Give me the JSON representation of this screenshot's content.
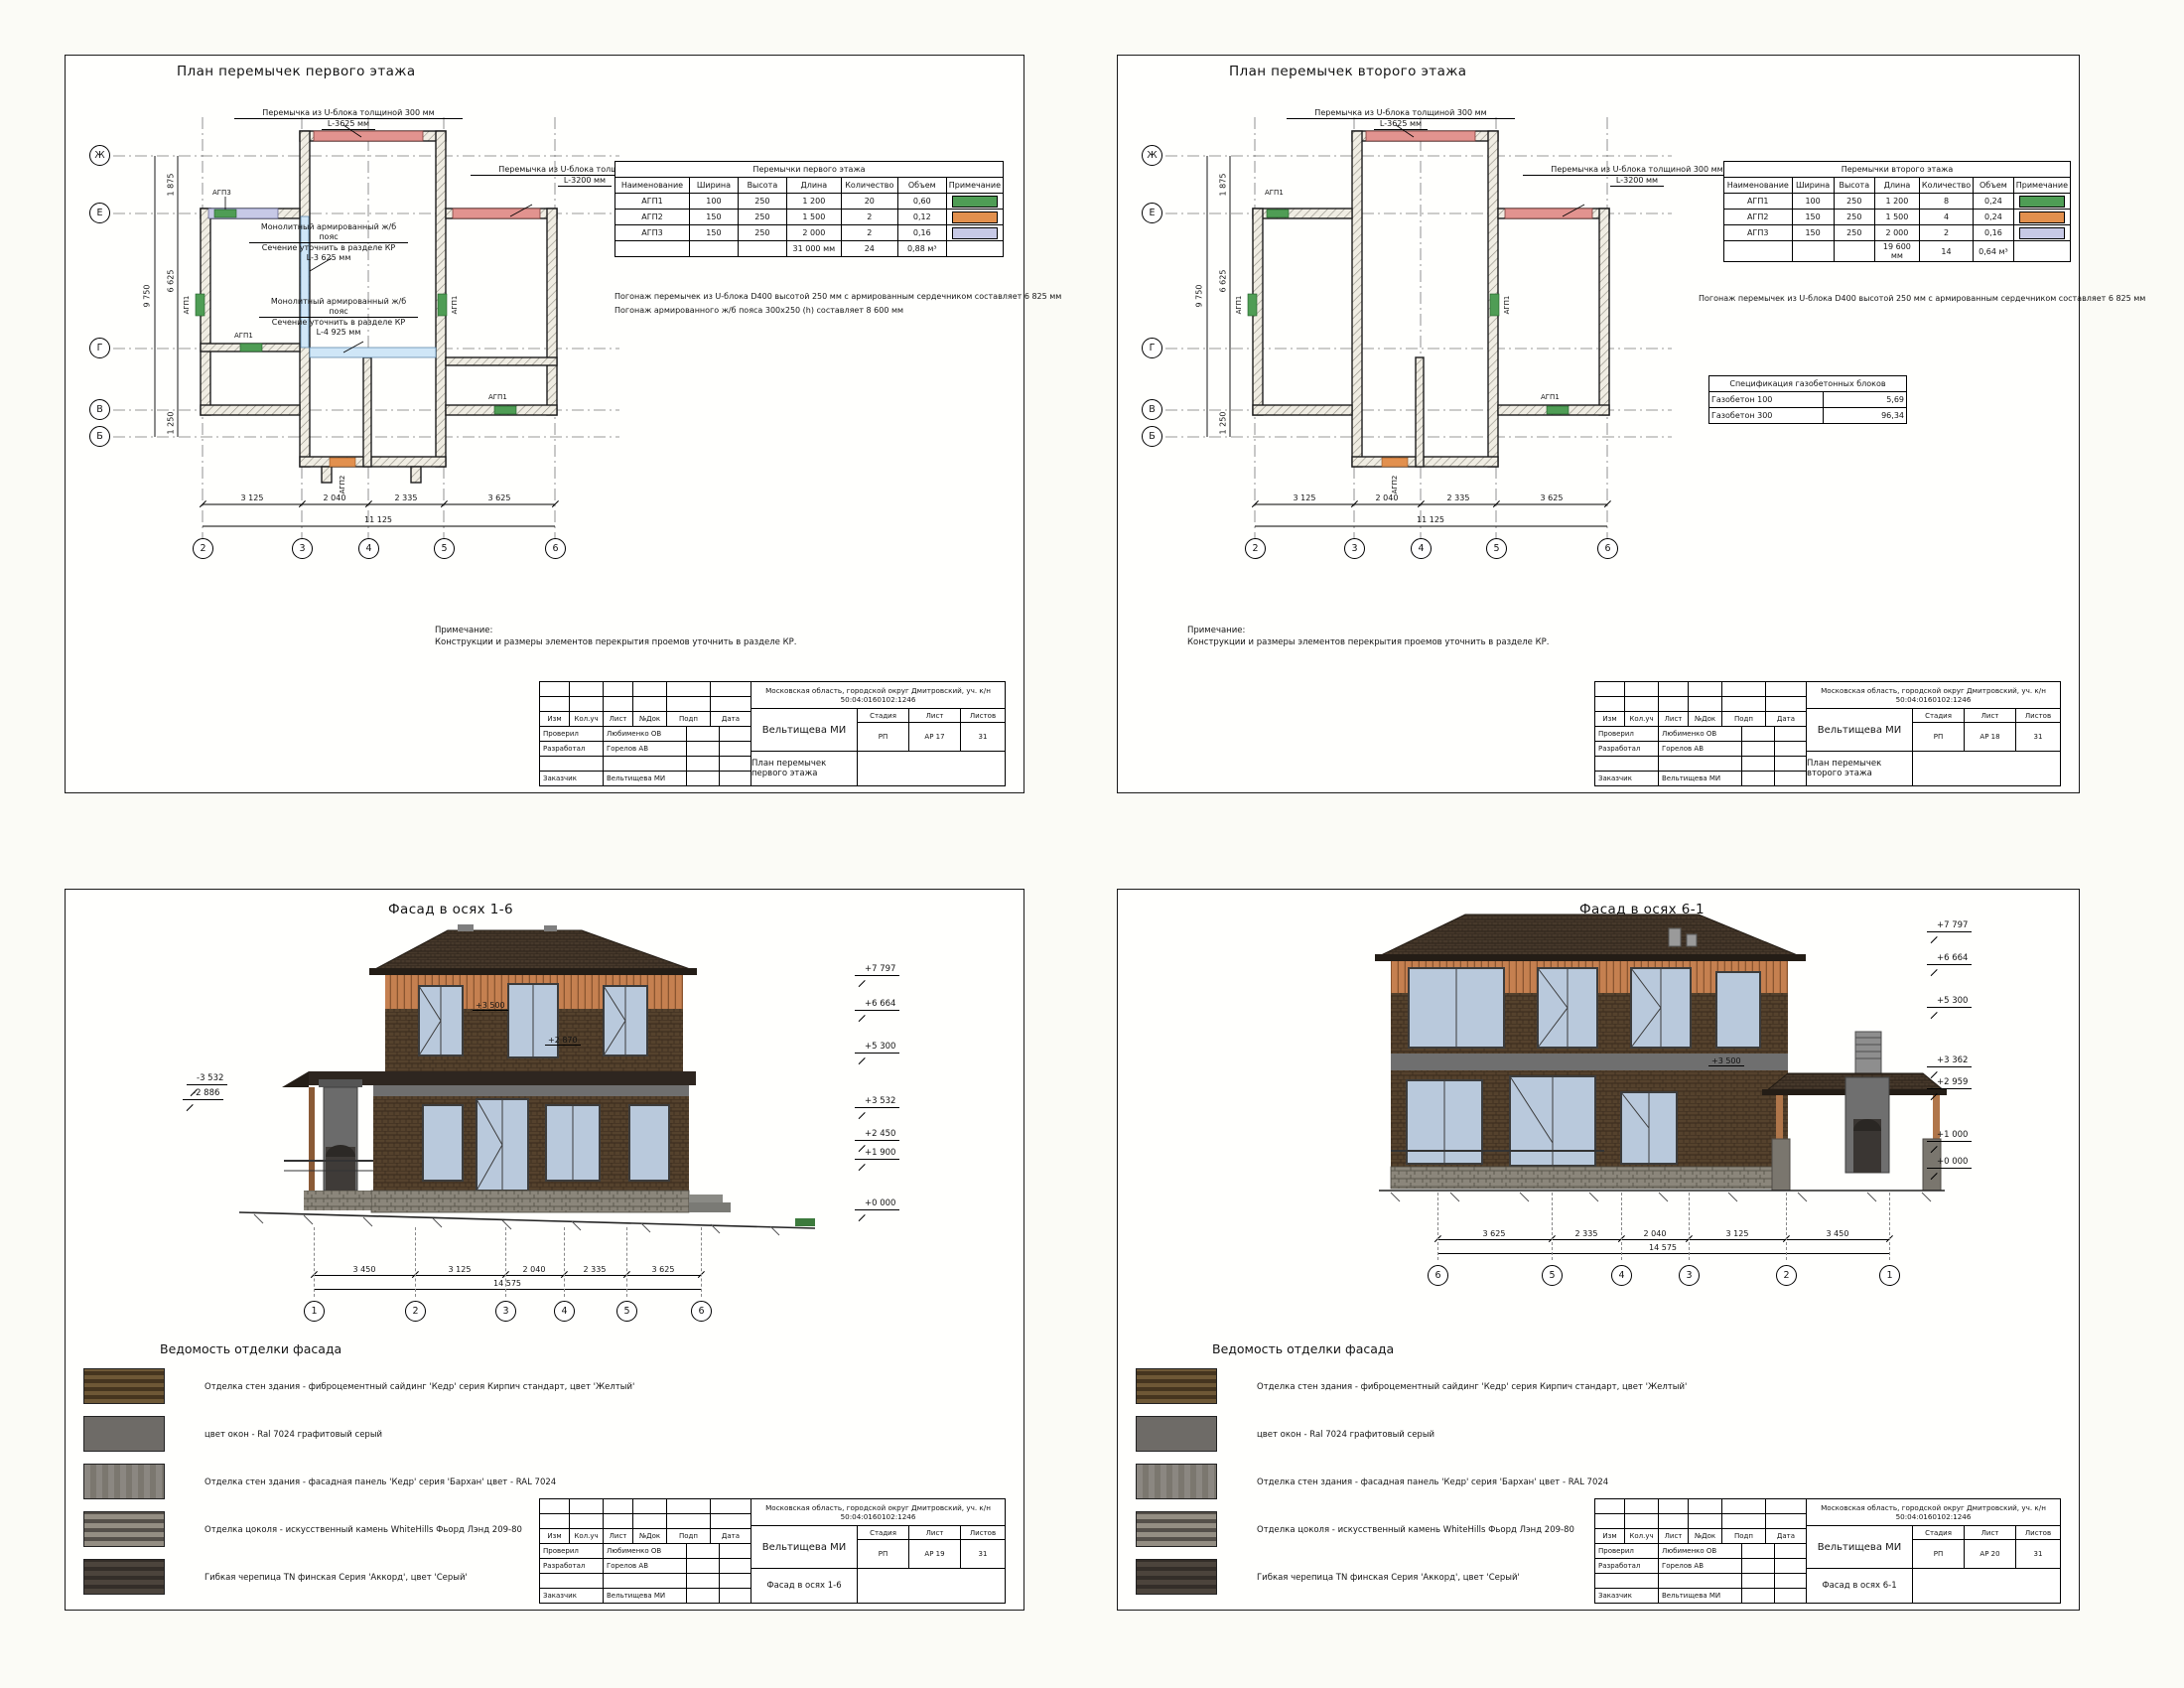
{
  "doc": {
    "tb": {
      "cols": [
        "Изм",
        "Кол.уч",
        "Лист",
        "№Док",
        "Подп",
        "Дата"
      ],
      "address": "Московская область, городской округ Дмитровский, уч. к/н 50:04:0160102:1246",
      "checked_label": "Проверил",
      "checked_name": "Любименко ОВ",
      "developed_label": "Разработал",
      "developed_name": "Горелов АВ",
      "client_label": "Заказчик",
      "client_name": "Вельтищева МИ",
      "object_name": "Вельтищева МИ",
      "stage_label": "Стадия",
      "sheet_label": "Лист",
      "sheets_label": "Листов",
      "stage": "РП",
      "sheets_total": "31"
    },
    "remark_title": "Примечание:",
    "remark": "Конструкции и размеры элементов перекрытия проемов уточнить в разделе КР."
  },
  "legend_colors": {
    "agp1": "#4f9d55",
    "agp2": "#e2904e",
    "agp3": "#c7c9e6",
    "ublock": "#e2938f",
    "belt": "#cfe6f7"
  },
  "plan1": {
    "title": "План перемычек первого этажа",
    "sheet_no": "АР 17",
    "callout_top_1": "Перемычка из U-блока толщиной 300 мм",
    "callout_top_2": "L-3625 мм",
    "callout_right_1": "Перемычка из U-блока толщиной 300 мм",
    "callout_right_2": "L-3200 мм",
    "belt1_1": "Монолитный армированный ж/б пояс",
    "belt1_2": "Сечение уточнить в разделе КР",
    "belt1_3": "L-3 625 мм",
    "belt2_1": "Монолитный армированный ж/б пояс",
    "belt2_2": "Сечение уточнить в разделе КР",
    "belt2_3": "L-4 925 мм",
    "lintels": [
      "АГП3",
      "АГП1",
      "АГП1",
      "АГП1",
      "АГП2",
      "АГП1"
    ],
    "table": {
      "title": "Перемычки первого этажа",
      "headers": [
        "Наименование",
        "Ширина",
        "Высота",
        "Длина",
        "Количество",
        "Объем",
        "Примечание"
      ],
      "rows": [
        [
          "АГП1",
          "100",
          "250",
          "1 200",
          "20",
          "0,60"
        ],
        [
          "АГП2",
          "150",
          "250",
          "1 500",
          "2",
          "0,12"
        ],
        [
          "АГП3",
          "150",
          "250",
          "2 000",
          "2",
          "0,16"
        ]
      ],
      "total": [
        "31 000 мм",
        "24",
        "0,88 м³"
      ]
    },
    "notes": [
      "Погонаж перемычек из U-блока D400 высотой 250 мм с армированным сердечником составляет 6 825 мм",
      "Погонаж армированного ж/б пояса 300х250 (h) составляет 8 600 мм"
    ],
    "axes_left": [
      "Ж",
      "Е",
      "Г",
      "В",
      "Б"
    ],
    "axes_bottom": [
      "2",
      "3",
      "4",
      "5",
      "6"
    ],
    "dims_left": [
      "1 875",
      "6 625",
      "1 250"
    ],
    "dim_left_total": "9 750",
    "dims_bottom": [
      "3 125",
      "2 040",
      "2 335",
      "3 625"
    ],
    "dim_bottom_total": "11 125"
  },
  "plan2": {
    "title": "План перемычек второго этажа",
    "sheet_no": "АР 18",
    "callout_top_1": "Перемычка из U-блока толщиной 300 мм",
    "callout_top_2": "L-3625 мм",
    "callout_right_1": "Перемычка из U-блока толщиной 300 мм",
    "callout_right_2": "L-3200 мм",
    "lintels": [
      "АГП1",
      "АГП1",
      "АГП1",
      "АГП2",
      "АГП1"
    ],
    "table": {
      "title": "Перемычки второго этажа",
      "headers": [
        "Наименование",
        "Ширина",
        "Высота",
        "Длина",
        "Количество",
        "Объем",
        "Примечание"
      ],
      "rows": [
        [
          "АГП1",
          "100",
          "250",
          "1 200",
          "8",
          "0,24"
        ],
        [
          "АГП2",
          "150",
          "250",
          "1 500",
          "4",
          "0,24"
        ],
        [
          "АГП3",
          "150",
          "250",
          "2 000",
          "2",
          "0,16"
        ]
      ],
      "total": [
        "19 600 мм",
        "14",
        "0,64 м³"
      ]
    },
    "notes": [
      "Погонаж перемычек из U-блока D400 высотой 250 мм с армированным сердечником составляет 6 825 мм"
    ],
    "spec": {
      "title": "Спецификация газобетонных блоков",
      "rows": [
        [
          "Газобетон 100",
          "5,69"
        ],
        [
          "Газобетон 300",
          "96,34"
        ]
      ]
    },
    "axes_left": [
      "Ж",
      "Е",
      "Г",
      "В",
      "Б"
    ],
    "axes_bottom": [
      "2",
      "3",
      "4",
      "5",
      "6"
    ],
    "dims_left": [
      "1 875",
      "6 625",
      "1 250"
    ],
    "dim_left_total": "9 750",
    "dims_bottom": [
      "3 125",
      "2 040",
      "2 335",
      "3 625"
    ],
    "dim_bottom_total": "11 125"
  },
  "facade16": {
    "title": "Фасад в осях 1-6",
    "sheet_no": "АР 19",
    "marks_right": [
      "+7 797",
      "+6 664",
      "+5 300",
      "+3 532",
      "+2 450",
      "+1 900",
      "+0 000"
    ],
    "marks_left": [
      "-3 532",
      "-2 886"
    ],
    "label_win": "+3 500",
    "label_win2": "+2 870",
    "dims": [
      "3 450",
      "3 125",
      "2 040",
      "2 335",
      "3 625"
    ],
    "dim_total": "14 575",
    "axes": [
      "1",
      "2",
      "3",
      "4",
      "5",
      "6"
    ]
  },
  "facade61": {
    "title": "Фасад в осях 6-1",
    "sheet_no": "АР 20",
    "marks_right": [
      "+7 797",
      "+6 664",
      "+5 300",
      "+3 362",
      "+2 959",
      "+1 000",
      "+0 000"
    ],
    "label_win": "+3 500",
    "dims": [
      "3 625",
      "2 335",
      "2 040",
      "3 125",
      "3 450"
    ],
    "dim_total": "14 575",
    "axes": [
      "6",
      "5",
      "4",
      "3",
      "2",
      "1"
    ]
  },
  "finish": {
    "title": "Ведомость отделки фасада",
    "items": [
      "Отделка стен здания - фиброцементный сайдинг 'Кедр' серия Кирпич стандарт, цвет 'Желтый'",
      "цвет окон - Ral 7024 графитовый серый",
      "Отделка стен здания - фасадная панель 'Кедр' серия 'Бархан' цвет - RAL 7024",
      "Отделка цоколя - искусственный камень WhiteHills Фьорд Лэнд 209-80",
      "Гибкая черепица TN финская Серия 'Аккорд', цвет 'Серый'"
    ]
  }
}
